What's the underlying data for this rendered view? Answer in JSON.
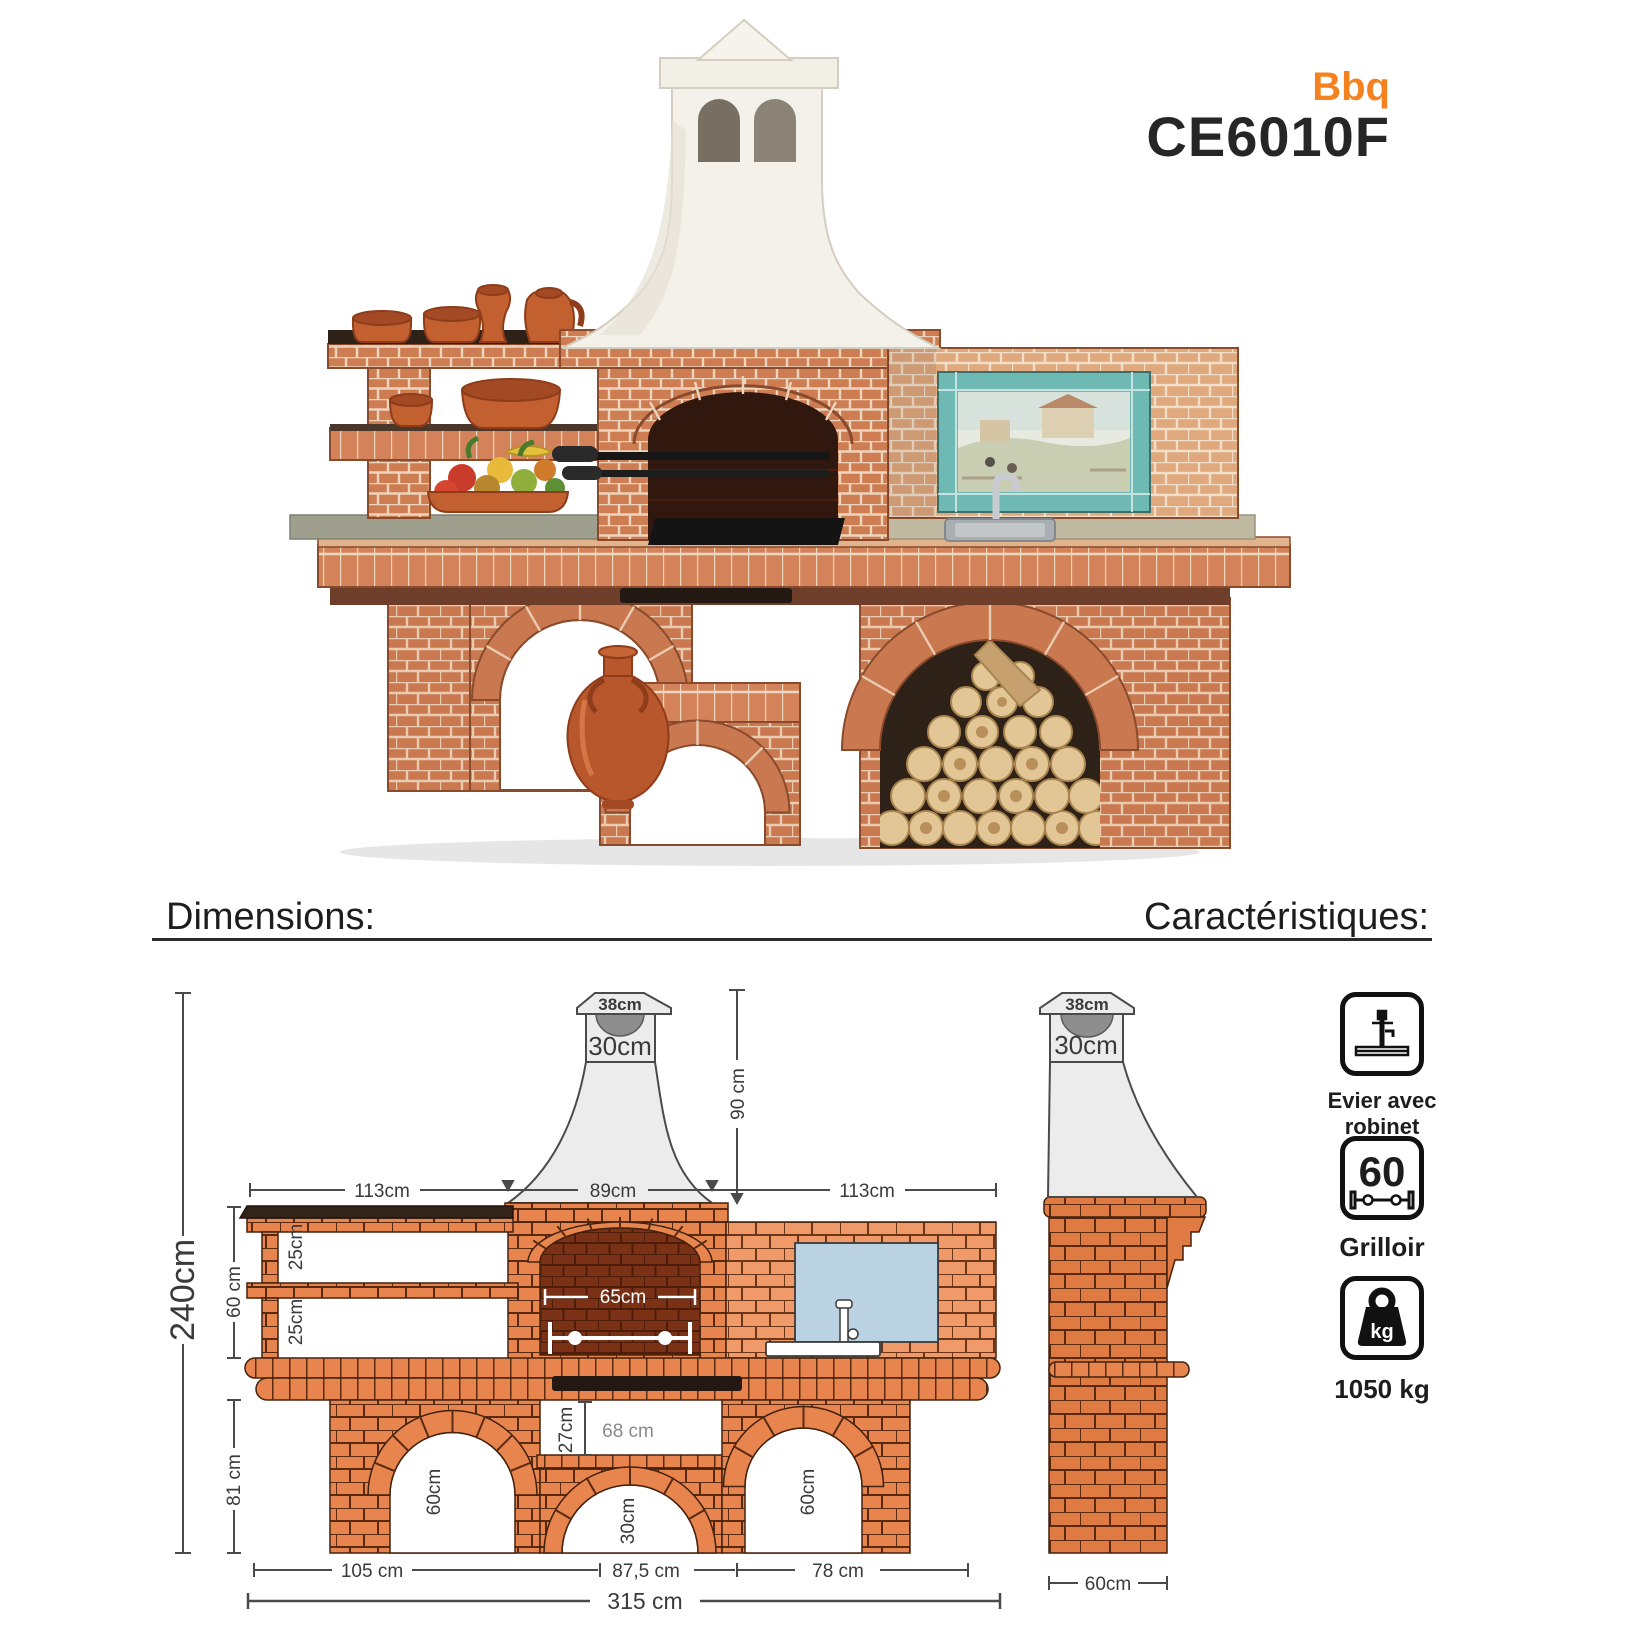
{
  "header": {
    "brand": "Bbq",
    "model": "CE6010F"
  },
  "section_headers": {
    "dimensions": "Dimensions:",
    "characteristics": "Caractéristiques:"
  },
  "front_view": {
    "chimney_cap_width": "38cm",
    "chimney_neck_width": "30cm",
    "hood_height": "90 cm",
    "left_section_width": "113cm",
    "firebox_section_width": "89cm",
    "right_section_width": "113cm",
    "total_height": "240cm",
    "shelf_zone_height": "60 cm",
    "upper_shelf_gap": "25cm",
    "lower_shelf_gap": "25cm",
    "firebox_opening_width": "65cm",
    "base_height": "81 cm",
    "niche_height": "27cm",
    "niche_width": "68 cm",
    "left_arch_height": "60cm",
    "middle_arch_height": "30cm",
    "right_arch_height": "60cm",
    "left_arch_span": "105 cm",
    "middle_span": "87,5 cm",
    "right_arch_span": "78 cm",
    "total_width": "315 cm"
  },
  "side_view": {
    "chimney_cap_width": "38cm",
    "chimney_neck_width": "30cm",
    "depth": "60cm"
  },
  "characteristics": [
    {
      "icon": "sink-faucet-icon",
      "label_line1": "Evier avec",
      "label_line2": "robinet"
    },
    {
      "icon": "rotisserie-icon",
      "value": "60",
      "label": "Grilloir"
    },
    {
      "icon": "weight-icon",
      "unit": "kg",
      "label": "1050 kg"
    }
  ],
  "colors": {
    "accent_orange": "#F5821F",
    "drawing_brick": "#E8854E",
    "firebox_brick": "#7A3115",
    "tile_blue": "#BBD2E2",
    "chimney_grey": "#ECECEC"
  }
}
